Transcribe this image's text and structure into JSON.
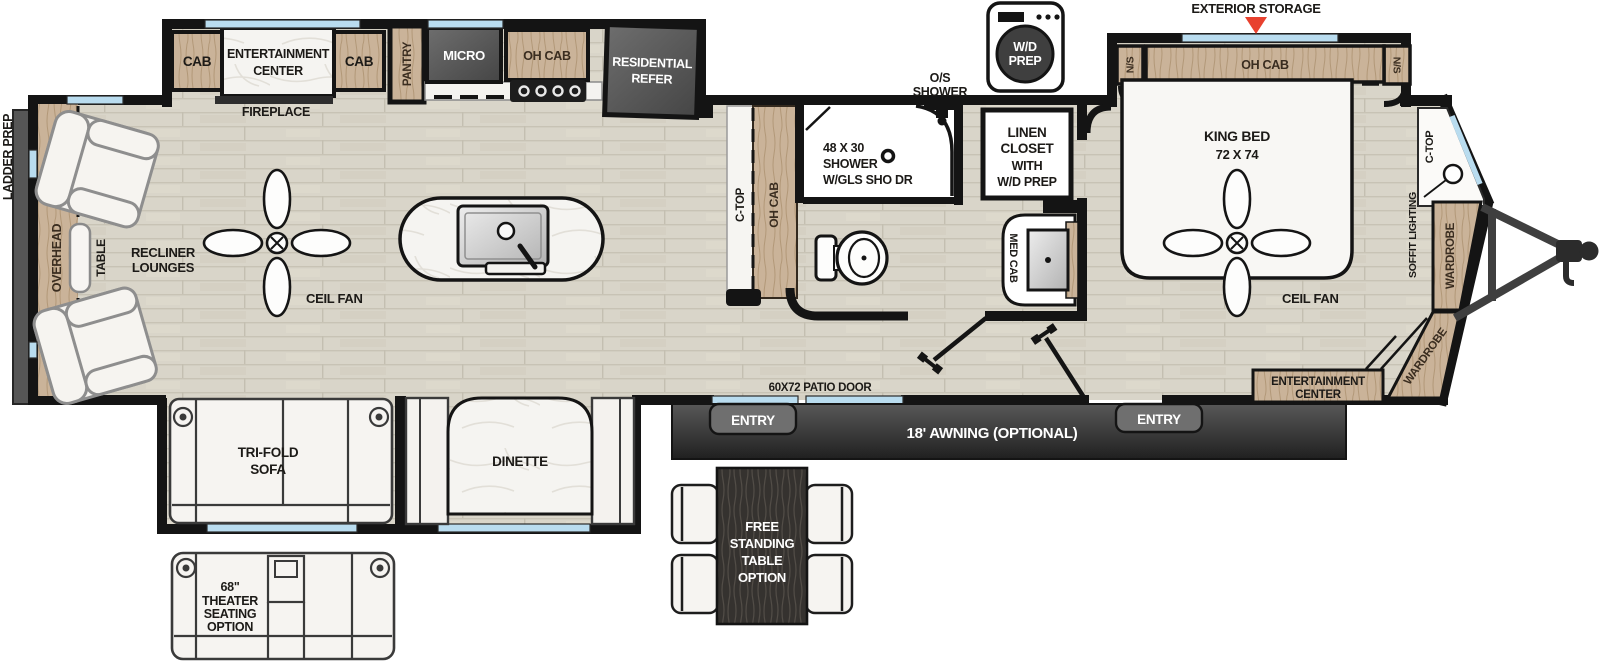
{
  "floorplan": {
    "rear": {
      "ladder_prep": "LADDER PREP",
      "overhead": "OVERHEAD",
      "table": "TABLE",
      "recliner_l1": "RECLINER",
      "recliner_l2": "LOUNGES",
      "ceil_fan": "CEIL FAN"
    },
    "galley_slide": {
      "cab_left": "CAB",
      "ent_l1": "ENTERTAINMENT",
      "ent_l2": "CENTER",
      "cab_right": "CAB",
      "fireplace": "FIREPLACE",
      "pantry": "PANTRY",
      "micro": "MICRO",
      "oh_cab": "OH CAB",
      "refer_l1": "RESIDENTIAL",
      "refer_l2": "REFER"
    },
    "kitchen": {
      "ctop": "C-TOP",
      "oh_cab": "OH CAB"
    },
    "bath": {
      "os_l1": "O/S",
      "os_l2": "SHOWER",
      "shower_l1": "48 X 30",
      "shower_l2": "SHOWER",
      "shower_l3": "W/GLS SHO DR",
      "linen_l1": "LINEN",
      "linen_l2": "CLOSET",
      "linen_l3": "WITH",
      "linen_l4": "W/D PREP",
      "med_cab": "MED CAB"
    },
    "washer": {
      "l1": "W/D",
      "l2": "PREP"
    },
    "bedroom": {
      "exterior_storage": "EXTERIOR STORAGE",
      "ns_left": "N/S",
      "ns_right": "N/S",
      "oh_cab": "OH CAB",
      "bed_l1": "KING BED",
      "bed_l2": "72 X 74",
      "ceil_fan": "CEIL FAN",
      "ent_l1": "ENTERTAINMENT",
      "ent_l2": "CENTER",
      "wardrobe_side": "WARDROBE",
      "wardrobe_front": "WARDROBE",
      "soffit": "SOFFIT  LIGHTING",
      "ctop": "C-TOP"
    },
    "bottom_slide": {
      "sofa_l1": "TRI-FOLD",
      "sofa_l2": "SOFA",
      "dinette": "DINETTE"
    },
    "exterior": {
      "patio_door": "60X72 PATIO DOOR",
      "entry_main": "ENTRY",
      "entry_bed": "ENTRY",
      "awning": "18' AWNING (OPTIONAL)"
    },
    "options": {
      "theater_l1": "68\"",
      "theater_l2": "THEATER",
      "theater_l3": "SEATING",
      "theater_l4": "OPTION",
      "fst_l1": "FREE",
      "fst_l2": "STANDING",
      "fst_l3": "TABLE",
      "fst_l4": "OPTION"
    }
  },
  "colors": {
    "floor": "#d9d5c9",
    "wood": "#c9b49c",
    "dark_appliance": "#585858",
    "window_blue": "#b9dcef",
    "wall": "#141414",
    "accent_red": "#e8412e",
    "awning_dark": "#2f2f2f",
    "marble": "#f5f4f1"
  }
}
